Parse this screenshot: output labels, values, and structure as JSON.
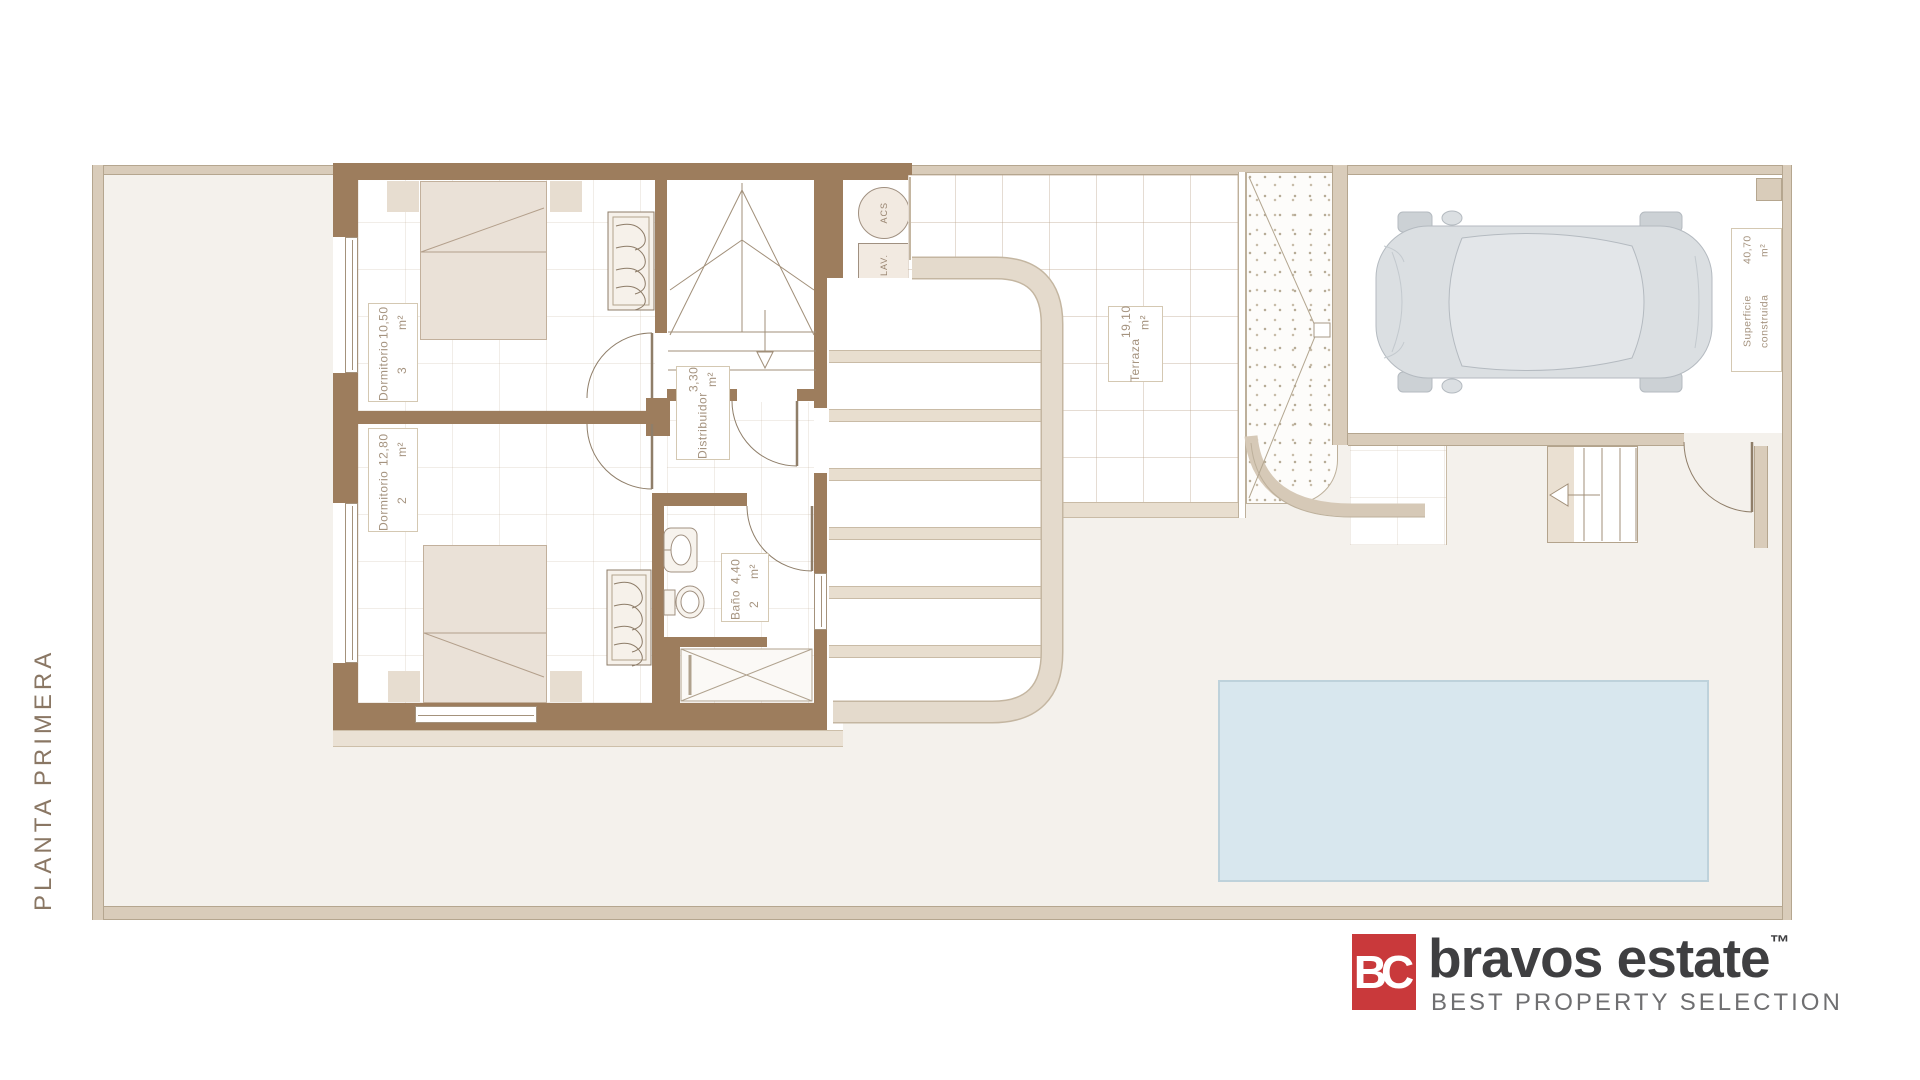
{
  "floor_label": "PLANTA PRIMERA",
  "rooms": {
    "dormitorio3": {
      "name": "Dormitorio 3",
      "area": "10,50 m²"
    },
    "dormitorio2": {
      "name": "Dormitorio 2",
      "area": "12,80 m²"
    },
    "distribuidor": {
      "name": "Distribuidor",
      "area": "3,30 m²"
    },
    "bano2": {
      "name": "Baño 2",
      "area": "4,40 m²"
    },
    "terraza": {
      "name": "Terraza",
      "area": "19,10 m²"
    },
    "superficie": {
      "name": "Superficie construida",
      "area": "40,70 m²"
    }
  },
  "equipment": {
    "acs": "ACS",
    "lav": "LAV."
  },
  "logo": {
    "monogram": "BC",
    "brand": "bravos estate",
    "trademark": "™",
    "tagline": "BEST PROPERTY SELECTION",
    "accent_color": "#c9393b"
  },
  "colors": {
    "wall_brown": "#9d7d5d",
    "boundary_beige": "#d9ccba",
    "garden": "#f4f1ec",
    "pool_fill": "#d8e7ee",
    "label_text": "#a5937f"
  }
}
